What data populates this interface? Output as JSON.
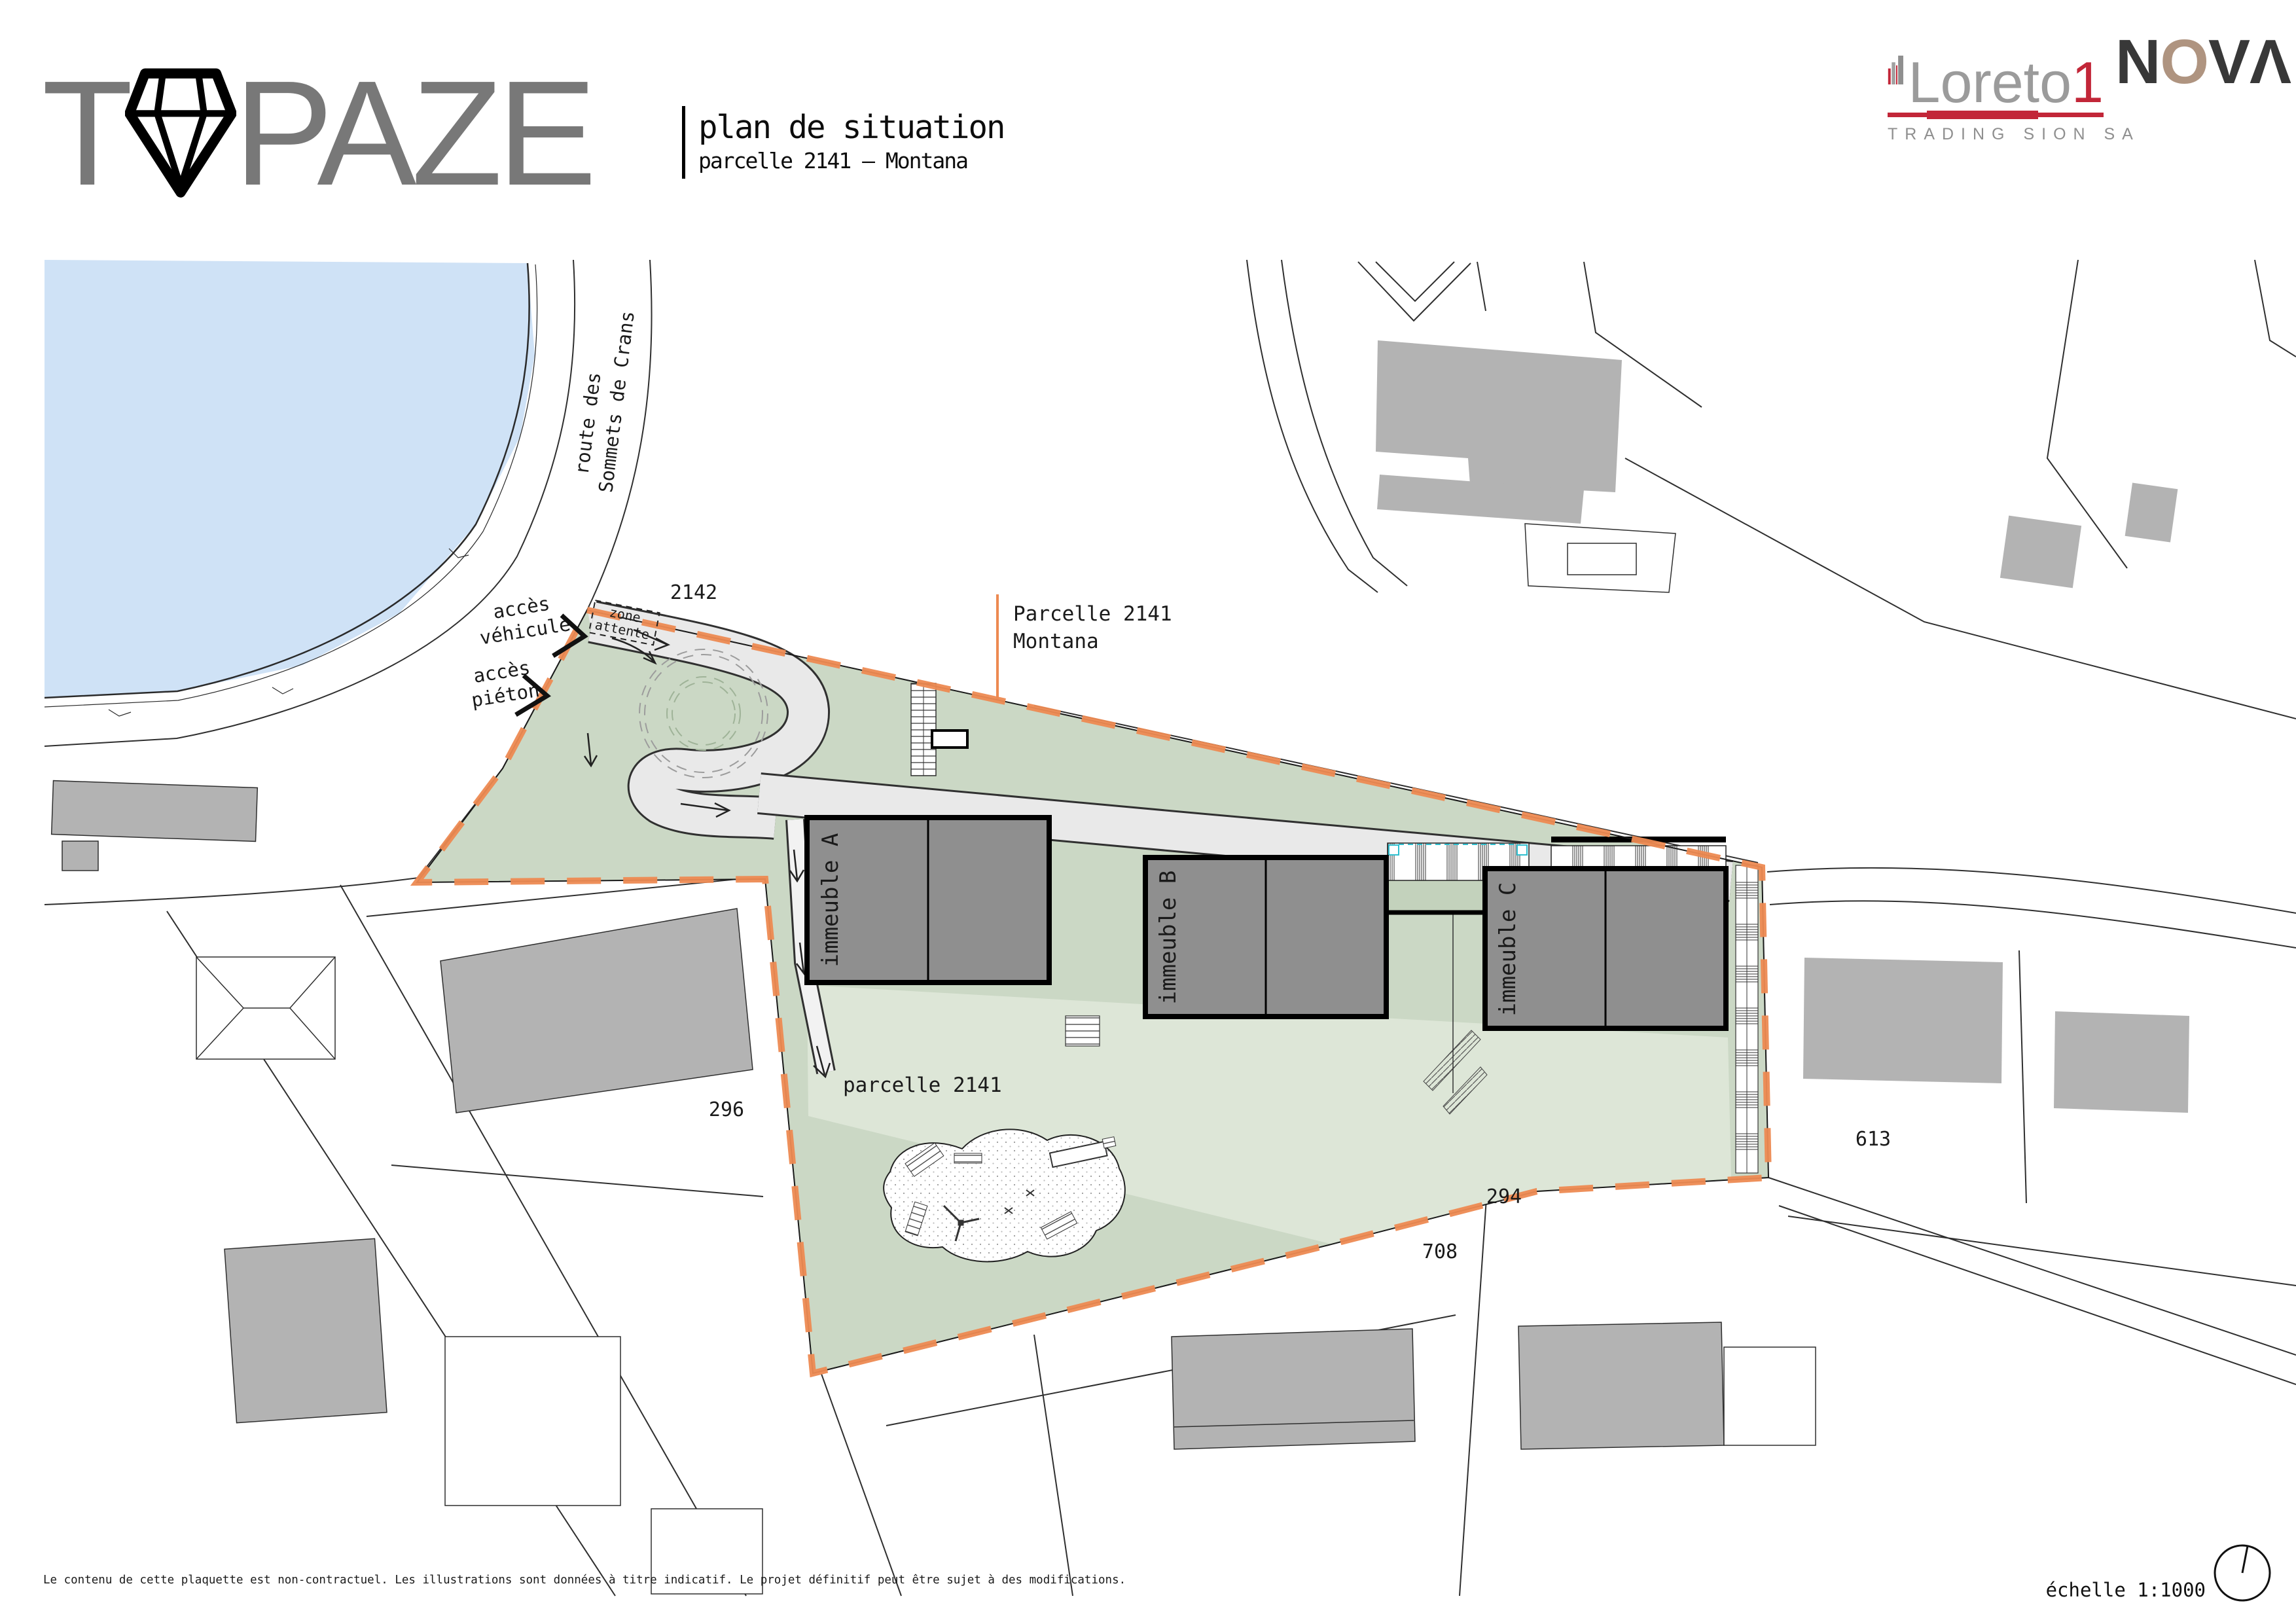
{
  "header": {
    "logo": {
      "t": "T",
      "rest": "PAZE",
      "diamond_icon": "diamond"
    },
    "title": "plan de situation",
    "subtitle": "parcelle 2141 – Montana",
    "loreto1": {
      "name": "Loreto",
      "one": "1",
      "tagline": "TRADING SION SA",
      "building_icon": "skyline"
    },
    "nova": {
      "n": "N",
      "o": "O",
      "v": "V",
      "a": "Λ"
    }
  },
  "plan": {
    "callout": {
      "line1": "Parcelle 2141",
      "line2": "Montana"
    },
    "street": {
      "line1": "route des",
      "line2": "Sommets de Crans"
    },
    "access_vehicle": {
      "line1": "accès",
      "line2": "véhicule"
    },
    "access_pedestrian": {
      "line1": "accès",
      "line2": "piéton"
    },
    "zone_attente": {
      "line1": "zone",
      "line2": "attente"
    },
    "inner_parcel": "parcelle 2141",
    "buildings": [
      {
        "label": "immeuble A"
      },
      {
        "label": "immeuble B"
      },
      {
        "label": "immeuble C"
      }
    ],
    "parcels": {
      "north": "2142",
      "west": "296",
      "south_left": "708",
      "south_right": "294",
      "east": "613"
    }
  },
  "footer": {
    "disclaimer": "Le contenu de cette plaquette est non-contractuel. Les illustrations sont données à titre indicatif. Le projet définitif peut être sujet à des modifications.",
    "scale_label": "échelle 1:1000",
    "compass_icon": "north-compass"
  },
  "colors": {
    "accent_orange": "#ed8a52",
    "parcel_green": "#cbd8c5",
    "parcel_green_light": "#dde6d7",
    "water_blue": "#cfe2f6",
    "building_gray": "#8f8f8f",
    "context_building_gray": "#b3b3b3",
    "road_gray": "#e9e9e9",
    "loreto_red": "#c22638",
    "nova_tan": "#af9480"
  }
}
